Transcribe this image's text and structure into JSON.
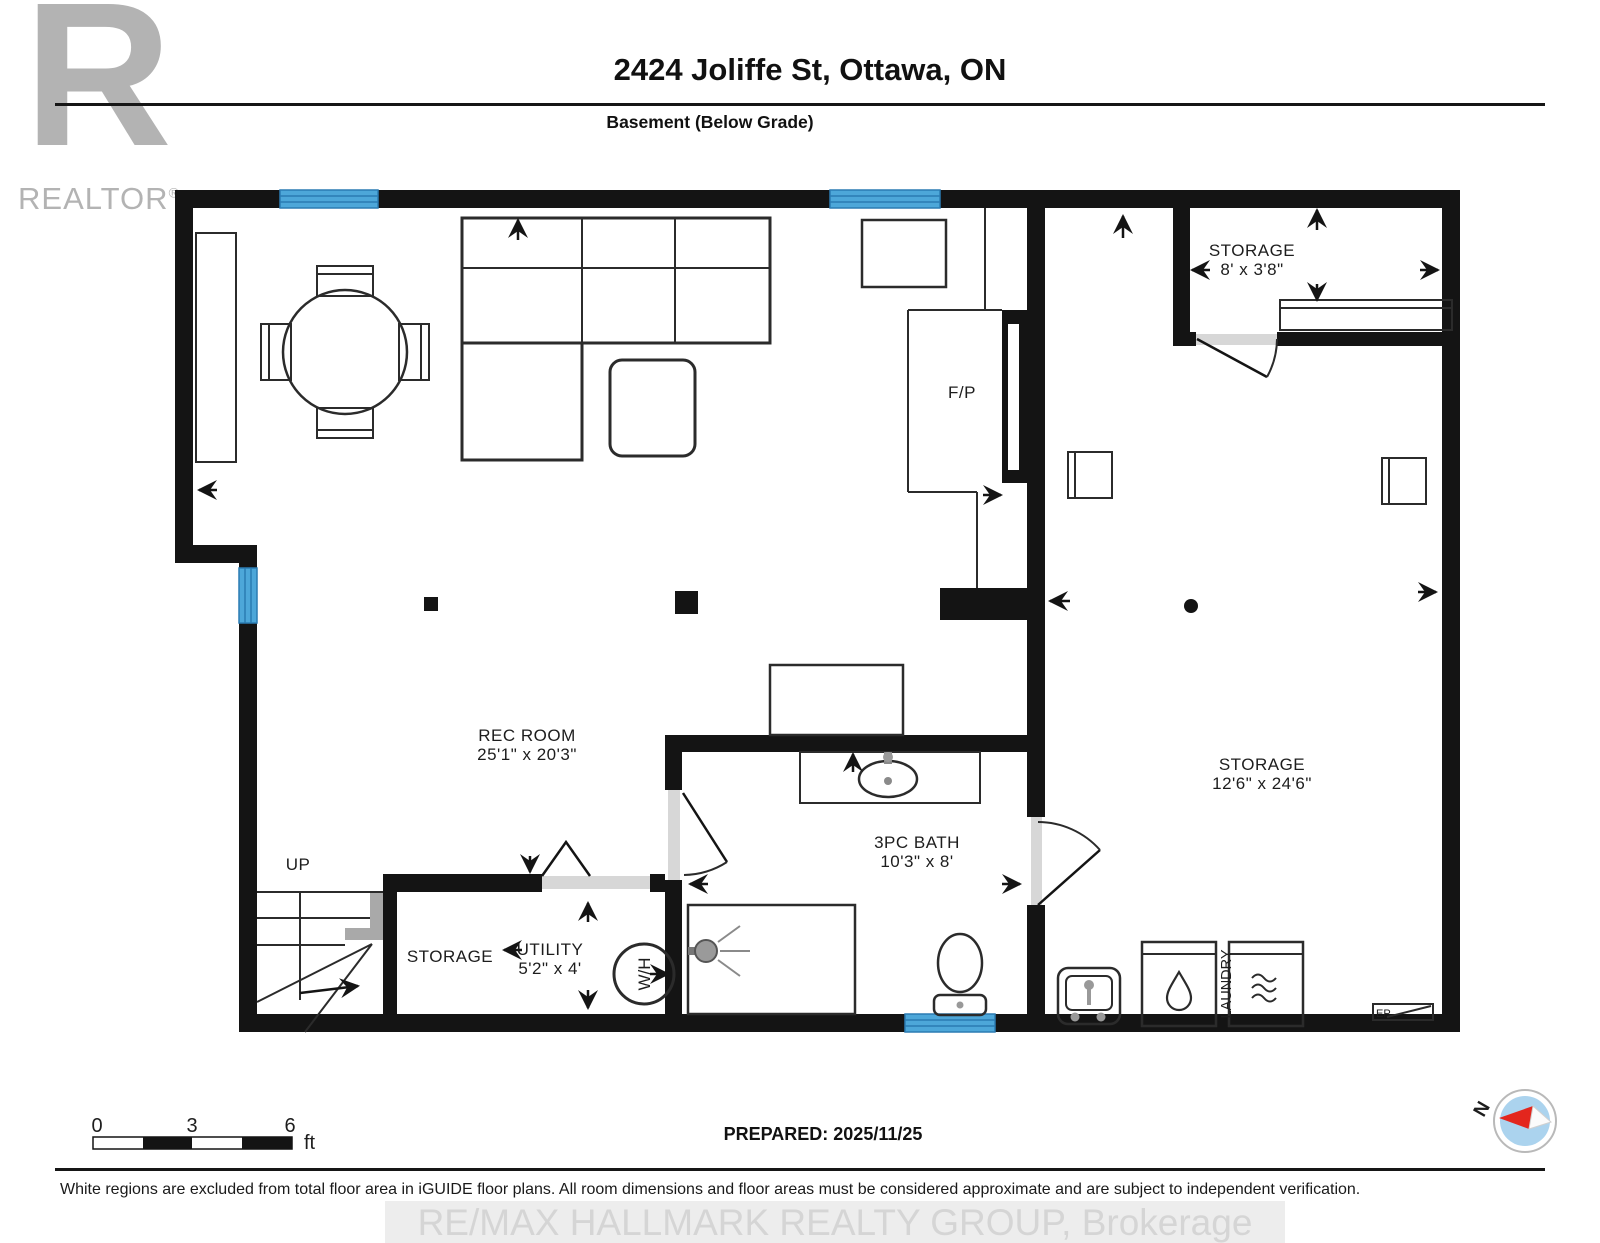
{
  "header": {
    "address": "2424 Joliffe St, Ottawa, ON",
    "floor_label": "Basement (Below Grade)",
    "logo_letter": "R",
    "logo_text": "REALTOR",
    "logo_reg": "®"
  },
  "plan": {
    "rooms": [
      {
        "name": "REC ROOM",
        "dims": "25'1\" x 20'3\""
      },
      {
        "name": "STORAGE",
        "dims": "8' x 3'8\""
      },
      {
        "name": "STORAGE",
        "dims": "12'6\" x 24'6\""
      },
      {
        "name": "3PC BATH",
        "dims": "10'3\" x 8'"
      },
      {
        "name": "UTILITY",
        "dims": "5'2\" x 4'"
      },
      {
        "name": "STORAGE",
        "dims": ""
      }
    ],
    "labels": {
      "fireplace": "F/P",
      "water_heater": "W/H",
      "stairs_up": "UP",
      "laundry": "LAUNDRY",
      "electrical_panel": "EP"
    },
    "colors": {
      "wall": "#141414",
      "window": "#4da7d9",
      "window_stripe": "#2b7cb3",
      "door": "#d7d7d7"
    }
  },
  "scale_bar": {
    "ticks": [
      "0",
      "3",
      "6"
    ],
    "unit": "ft"
  },
  "footer": {
    "prepared": "PREPARED: 2025/11/25",
    "compass_north": "N",
    "disclaimer": "White regions are excluded from total floor area in iGUIDE floor plans. All room dimensions and floor areas must be considered approximate and are subject to independent verification.",
    "watermark": "RE/MAX HALLMARK REALTY GROUP, Brokerage"
  }
}
